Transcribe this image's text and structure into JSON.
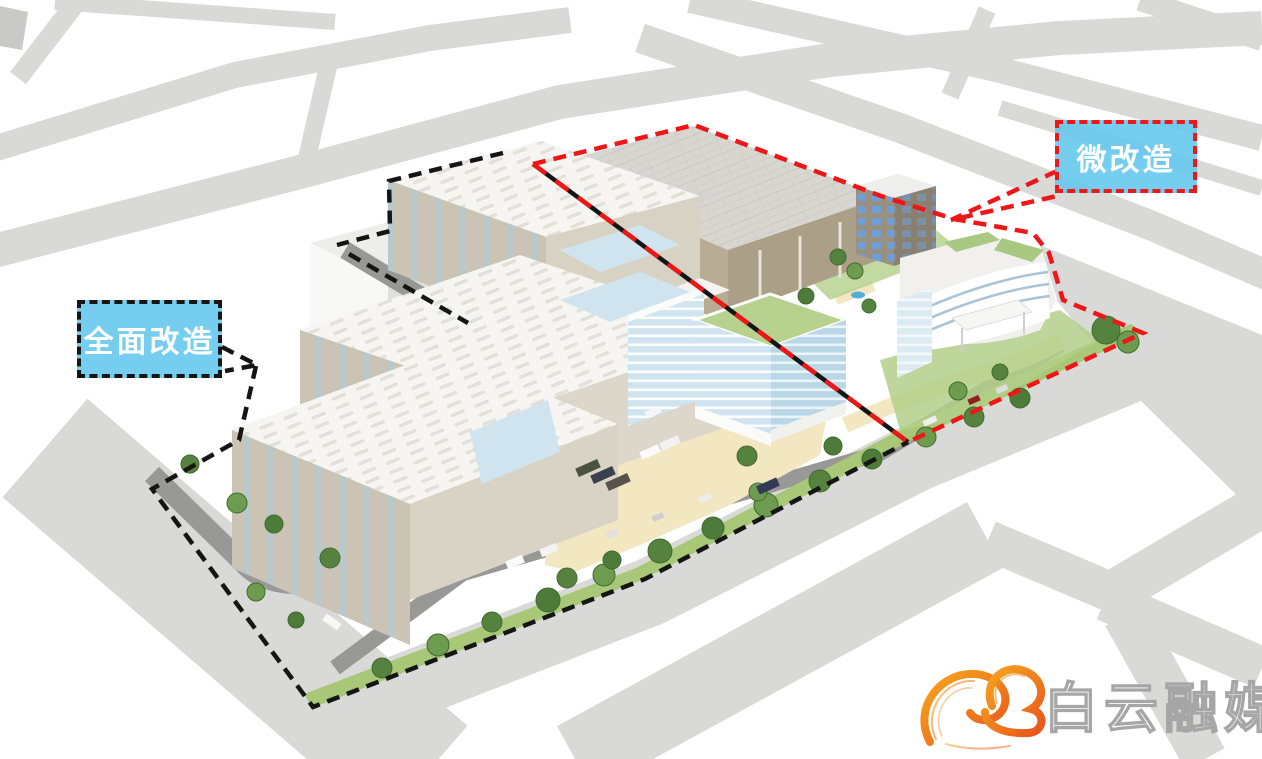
{
  "zones": {
    "full": {
      "label": "全面改造",
      "outline_color": "#151515"
    },
    "micro": {
      "label": "微改造",
      "outline_color": "#ee1616"
    },
    "label_fill": "rgba(98,199,238,0.88)",
    "label_text": "#ffffff"
  },
  "logo": {
    "text": "白云融媒",
    "text_fill": "#ffffff",
    "text_outline": "#a6a6a6",
    "mark": "cloud-swirl-icon",
    "mark_color_start": "#f6a61e",
    "mark_color_end": "#e8531a"
  },
  "palette": {
    "background": "#ffffff",
    "road": "#d9d9d8",
    "internal_road": "#989896",
    "sand": "#f3e7c2",
    "lawn": "#a8c878",
    "tree_green": "#55833f",
    "building_wall": "#cbc4b4",
    "building_roof": "#f5f4f0",
    "warehouse_wall": "#b3a78f",
    "glass_blue": "#cfe4ef",
    "green_roof": "#b7d18f",
    "pond_blue": "#4fb0d6"
  }
}
